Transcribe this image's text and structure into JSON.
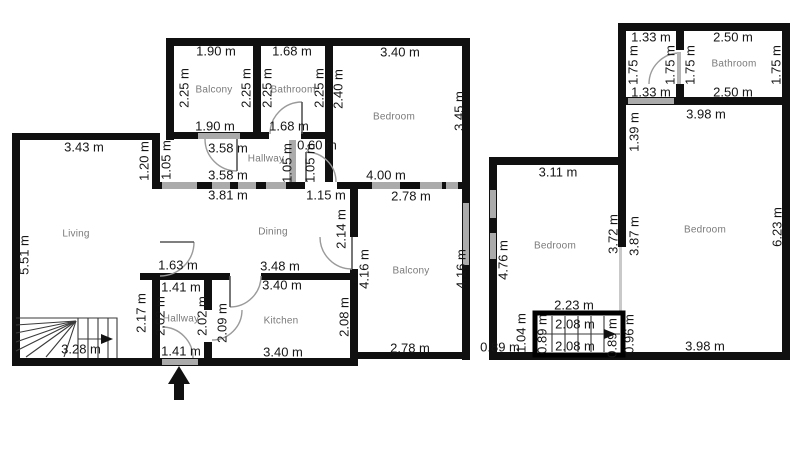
{
  "meta": {
    "kind": "floor-plan",
    "units": "m"
  },
  "colors": {
    "wall": "#101010",
    "window": "#ababab",
    "dimension_text": "#161616",
    "room_text": "#7a7a7a",
    "background": "#ffffff"
  },
  "floorplan": {
    "rooms": [
      {
        "name": "Balcony",
        "x": 214,
        "y": 90
      },
      {
        "name": "Bathroom",
        "x": 293,
        "y": 90
      },
      {
        "name": "Bedroom",
        "x": 394,
        "y": 117
      },
      {
        "name": "Hallway",
        "x": 266,
        "y": 159
      },
      {
        "name": "Living",
        "x": 76,
        "y": 234
      },
      {
        "name": "Dining",
        "x": 273,
        "y": 232
      },
      {
        "name": "Balcony",
        "x": 411,
        "y": 271
      },
      {
        "name": "Hallway",
        "x": 181,
        "y": 319
      },
      {
        "name": "Kitchen",
        "x": 281,
        "y": 321
      },
      {
        "name": "Bathroom",
        "x": 734,
        "y": 64
      },
      {
        "name": "Bedroom",
        "x": 555,
        "y": 246
      },
      {
        "name": "Bedroom",
        "x": 705,
        "y": 230
      }
    ],
    "dims_h": [
      {
        "t": "1.90 m",
        "x": 216,
        "y": 51
      },
      {
        "t": "1.68 m",
        "x": 292,
        "y": 51
      },
      {
        "t": "3.40 m",
        "x": 400,
        "y": 52
      },
      {
        "t": "1.90 m",
        "x": 215,
        "y": 126
      },
      {
        "t": "1.68 m",
        "x": 289,
        "y": 126
      },
      {
        "t": "3.43 m",
        "x": 84,
        "y": 147
      },
      {
        "t": "3.58 m",
        "x": 228,
        "y": 148
      },
      {
        "t": "0.60 m",
        "x": 317,
        "y": 145
      },
      {
        "t": "3.58 m",
        "x": 228,
        "y": 175
      },
      {
        "t": "4.00 m",
        "x": 386,
        "y": 175
      },
      {
        "t": "3.81 m",
        "x": 228,
        "y": 195
      },
      {
        "t": "1.15 m",
        "x": 326,
        "y": 195
      },
      {
        "t": "2.78 m",
        "x": 411,
        "y": 196
      },
      {
        "t": "1.63 m",
        "x": 178,
        "y": 265
      },
      {
        "t": "3.48 m",
        "x": 280,
        "y": 266
      },
      {
        "t": "3.40 m",
        "x": 282,
        "y": 285
      },
      {
        "t": "1.41 m",
        "x": 181,
        "y": 287
      },
      {
        "t": "3.28 m",
        "x": 81,
        "y": 349
      },
      {
        "t": "1.41 m",
        "x": 181,
        "y": 351
      },
      {
        "t": "3.40 m",
        "x": 283,
        "y": 352
      },
      {
        "t": "2.78 m",
        "x": 410,
        "y": 348
      },
      {
        "t": "1.33 m",
        "x": 651,
        "y": 37
      },
      {
        "t": "2.50 m",
        "x": 733,
        "y": 37
      },
      {
        "t": "1.33 m",
        "x": 651,
        "y": 92
      },
      {
        "t": "2.50 m",
        "x": 733,
        "y": 92
      },
      {
        "t": "3.98 m",
        "x": 706,
        "y": 114
      },
      {
        "t": "3.11 m",
        "x": 558,
        "y": 172
      },
      {
        "t": "2.23 m",
        "x": 574,
        "y": 305
      },
      {
        "t": "0.89 m",
        "x": 500,
        "y": 347
      },
      {
        "t": "2.08 m",
        "x": 575,
        "y": 324
      },
      {
        "t": "2.08 m",
        "x": 575,
        "y": 346
      },
      {
        "t": "3.98 m",
        "x": 705,
        "y": 346
      }
    ],
    "dims_v": [
      {
        "t": "2.25 m",
        "x": 184,
        "y": 88
      },
      {
        "t": "2.25 m",
        "x": 246,
        "y": 88
      },
      {
        "t": "2.25 m",
        "x": 267,
        "y": 88
      },
      {
        "t": "2.25 m",
        "x": 319,
        "y": 88
      },
      {
        "t": "2.40 m",
        "x": 338,
        "y": 89
      },
      {
        "t": "3.45 m",
        "x": 459,
        "y": 111
      },
      {
        "t": "1.20 m",
        "x": 144,
        "y": 161
      },
      {
        "t": "1.05 m",
        "x": 166,
        "y": 160
      },
      {
        "t": "1.05 m",
        "x": 287,
        "y": 163
      },
      {
        "t": "1.05 m",
        "x": 310,
        "y": 163
      },
      {
        "t": "5.51 m",
        "x": 24,
        "y": 255
      },
      {
        "t": "2.14 m",
        "x": 341,
        "y": 229
      },
      {
        "t": "4.16 m",
        "x": 364,
        "y": 269
      },
      {
        "t": "4.16 m",
        "x": 461,
        "y": 269
      },
      {
        "t": "2.17 m",
        "x": 141,
        "y": 313
      },
      {
        "t": "2.02 m",
        "x": 160,
        "y": 316
      },
      {
        "t": "2.02 m",
        "x": 202,
        "y": 316
      },
      {
        "t": "2.09 m",
        "x": 222,
        "y": 323
      },
      {
        "t": "2.08 m",
        "x": 344,
        "y": 317
      },
      {
        "t": "1.75 m",
        "x": 633,
        "y": 65
      },
      {
        "t": "1.75 m",
        "x": 670,
        "y": 65
      },
      {
        "t": "1.75 m",
        "x": 690,
        "y": 65
      },
      {
        "t": "1.75 m",
        "x": 776,
        "y": 65
      },
      {
        "t": "1.39 m",
        "x": 634,
        "y": 132
      },
      {
        "t": "4.76 m",
        "x": 503,
        "y": 260
      },
      {
        "t": "3.72 m",
        "x": 613,
        "y": 234
      },
      {
        "t": "3.87 m",
        "x": 634,
        "y": 236
      },
      {
        "t": "6.23 m",
        "x": 777,
        "y": 227
      },
      {
        "t": "1.04 m",
        "x": 521,
        "y": 333
      },
      {
        "t": "0.89 m",
        "x": 542,
        "y": 334
      },
      {
        "t": "0.89 m",
        "x": 612,
        "y": 338
      },
      {
        "t": "0.96 m",
        "x": 629,
        "y": 334
      }
    ],
    "annotations": [
      {
        "name": "entrance-arrow",
        "meaning": "main entrance, points up"
      },
      {
        "name": "stairs-direction-arrow-left",
        "meaning": "stair run direction, points right"
      },
      {
        "name": "stairs-direction-arrow-right",
        "meaning": "stair run direction, points right"
      }
    ]
  }
}
